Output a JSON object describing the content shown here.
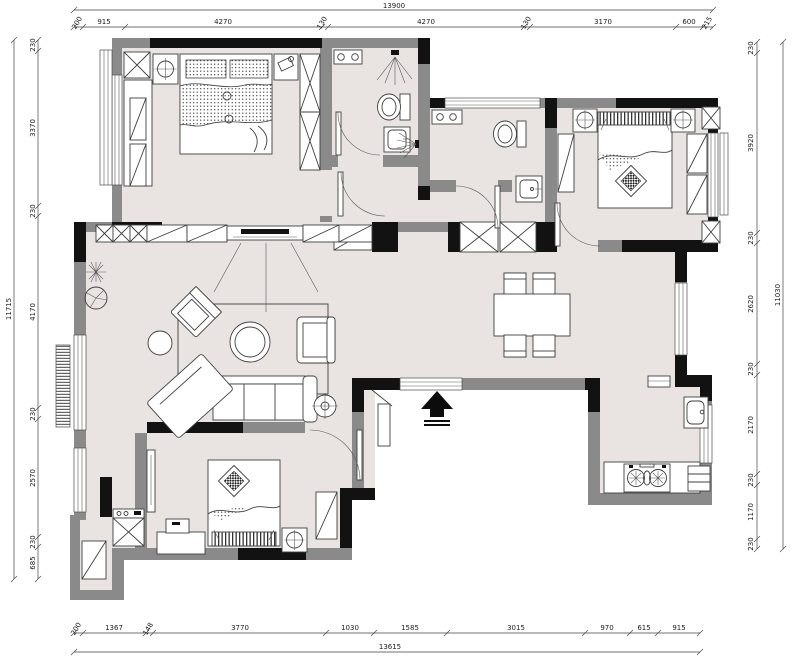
{
  "dimensions": {
    "top": {
      "total": "13900",
      "segments": [
        "200",
        "915",
        "4270",
        "130",
        "4270",
        "130",
        "3170",
        "600",
        "215"
      ]
    },
    "bottom": {
      "total": "13615",
      "segments": [
        "200",
        "1367",
        "148",
        "3770",
        "1030",
        "1585",
        "3015",
        "970",
        "615",
        "915"
      ]
    },
    "left": {
      "total": "11715",
      "segments": [
        "230",
        "3370",
        "230",
        "4170",
        "230",
        "2570",
        "230",
        "685"
      ]
    },
    "right": {
      "total": "11030",
      "segments": [
        "230",
        "3920",
        "230",
        "2620",
        "230",
        "2170",
        "230",
        "1170",
        "230"
      ]
    }
  },
  "symbols": {
    "entrance_arrow": "▲"
  },
  "colors": {
    "floor": "#e9e4e2",
    "wall_gray": "#8a8a8a",
    "wall_dark": "#121212",
    "line": "#3f3f3f",
    "dim_text": "#1c1c1c"
  }
}
